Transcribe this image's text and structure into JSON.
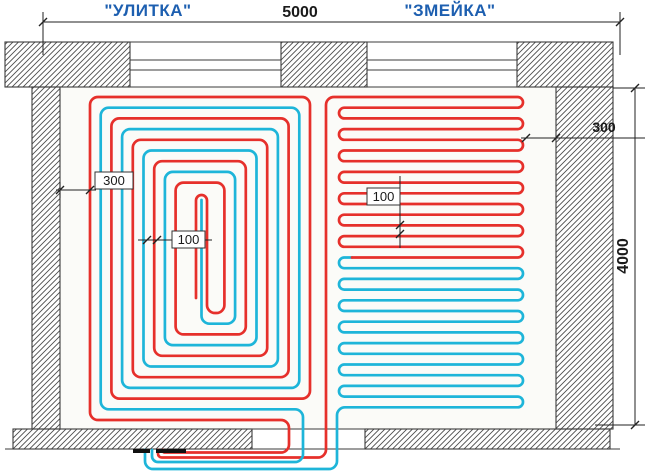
{
  "labels": {
    "left_scheme": "\"УЛИТКА\"",
    "right_scheme": "\"ЗМЕЙКА\""
  },
  "dimensions": {
    "room_width": "5000",
    "room_height": "4000",
    "edge_offset_left": "300",
    "edge_offset_right": "300",
    "pipe_spacing_spiral": "100",
    "pipe_spacing_serpentine": "100"
  },
  "colors": {
    "supply": "#e6302b",
    "return": "#1eb5d9",
    "label_blue": "#1d5fb0",
    "line": "#222222",
    "outline": "#3b3b3b",
    "hatch": "#4d4d4d",
    "floor": "#fbfbf8"
  },
  "pipes": {
    "stroke_width": 2.7,
    "corner_radius": 8,
    "spiral": {
      "left": 90,
      "top": 97,
      "right": 310,
      "bottom": 420,
      "step": 21.4,
      "red_wraps": 5,
      "cyan_wraps": 4,
      "red_entry": [
        [
          163,
          450
        ],
        [
          163,
          452.5
        ],
        [
          289,
          452.5
        ],
        [
          289,
          420
        ]
      ],
      "red_center": [
        [
          207,
          313
        ],
        [
          207,
          195
        ],
        [
          196,
          195
        ],
        [
          196,
          298
        ]
      ],
      "cyan_entry": [
        [
          152,
          450
        ],
        [
          152,
          462
        ],
        [
          303,
          462
        ],
        [
          303,
          409.3
        ]
      ],
      "cyan_center": [
        [
          201.5,
          323.7
        ],
        [
          201.5,
          200
        ]
      ]
    },
    "serpentine": {
      "top": 97,
      "step": 10.7,
      "x_left": 339,
      "x_right": 523,
      "red_entry": [
        [
          158,
          450
        ],
        [
          158,
          457.5
        ],
        [
          326,
          457.5
        ],
        [
          326,
          97
        ]
      ],
      "red_turn_range": [
        0,
        14
      ],
      "red_end": [
        352,
        257.5
      ],
      "cyan_start": [
        [
          352,
          257.5
        ],
        [
          339,
          257.5
        ],
        [
          339,
          268.2
        ]
      ],
      "cyan_turn_range": [
        16,
        28
      ],
      "cyan_exit": [
        [
          337,
          407.3
        ],
        [
          337,
          469
        ],
        [
          145,
          469
        ],
        [
          145,
          450
        ]
      ]
    }
  }
}
